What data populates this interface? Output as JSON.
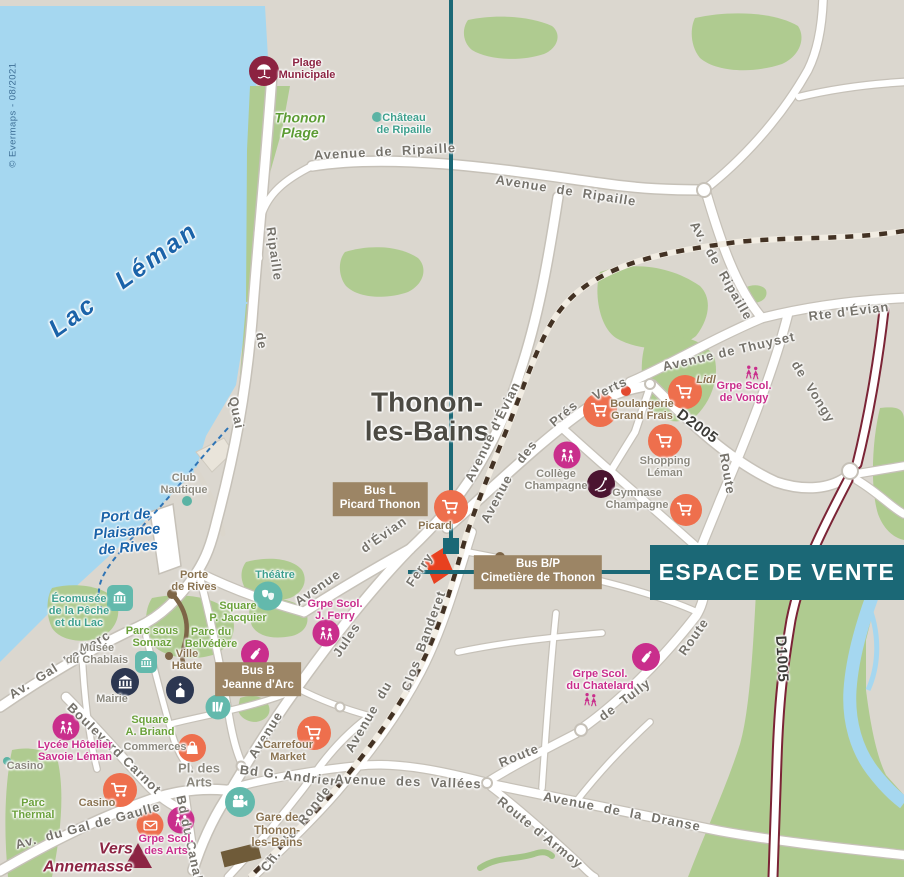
{
  "meta": {
    "banner_label": "ESPACE DE VENTE",
    "copyright": "© Evermaps - 08/2021"
  },
  "colors": {
    "accent": "#1b6876",
    "land": "#dbd7cf",
    "water": "#a5d7f0",
    "green": "#afcb90",
    "orange_poi": "#ee6f4d",
    "pink_poi": "#c92e8c",
    "teal_poi": "#63b9ac",
    "navy_poi": "#2c3751",
    "maroon_poi": "#8c2341",
    "dark_maroon_poi": "#4b1430",
    "brown_badge": "#9c8565",
    "brown_dot": "#7d6547",
    "red_site_marker": "#e8401f",
    "railway": "#433224",
    "d_road_border": "#7b2436"
  },
  "labels": [
    {
      "t": "Thonon-\nles-Bains",
      "x": 427,
      "y": 417,
      "c": "city",
      "n": "city-name"
    },
    {
      "t": "Lac   Léman",
      "x": 124,
      "y": 280,
      "r": -36,
      "c": "water-lg",
      "n": "lake-name"
    },
    {
      "t": "Port de\nPlaisance\nde Rives",
      "x": 127,
      "y": 533,
      "r": -5,
      "c": "water-md",
      "n": "port-name"
    },
    {
      "t": "Avenue  de  Ripaille",
      "x": 385,
      "y": 152,
      "r": -3,
      "c": "street"
    },
    {
      "t": "Avenue  de  Ripaille",
      "x": 566,
      "y": 191,
      "r": 9,
      "c": "street"
    },
    {
      "t": "Av.  de  Ripaille",
      "x": 721,
      "y": 271,
      "r": 60,
      "c": "street"
    },
    {
      "t": "Rte d'Évian",
      "x": 849,
      "y": 312,
      "r": -7,
      "c": "street"
    },
    {
      "t": "Avenue de Thuyset",
      "x": 729,
      "y": 352,
      "r": -13,
      "c": "street"
    },
    {
      "t": "de  Vongy",
      "x": 813,
      "y": 392,
      "r": 58,
      "c": "street"
    },
    {
      "t": "Route",
      "x": 727,
      "y": 474,
      "r": 80,
      "c": "street"
    },
    {
      "t": "Avenue d'Évian",
      "x": 493,
      "y": 432,
      "r": -64,
      "c": "street"
    },
    {
      "t": "Avenue",
      "x": 318,
      "y": 588,
      "r": -35,
      "c": "street"
    },
    {
      "t": "d'Évian",
      "x": 384,
      "y": 535,
      "r": -35,
      "c": "street"
    },
    {
      "t": "Avenue",
      "x": 497,
      "y": 499,
      "r": -62,
      "c": "street"
    },
    {
      "t": "des",
      "x": 527,
      "y": 452,
      "r": -52,
      "c": "street"
    },
    {
      "t": "Prés",
      "x": 564,
      "y": 414,
      "r": -40,
      "c": "street"
    },
    {
      "t": "Verts",
      "x": 610,
      "y": 389,
      "r": -26,
      "c": "street"
    },
    {
      "t": "Jules",
      "x": 347,
      "y": 640,
      "r": -56,
      "c": "street"
    },
    {
      "t": "Ferry",
      "x": 420,
      "y": 570,
      "r": -56,
      "c": "street"
    },
    {
      "t": "Avenue",
      "x": 266,
      "y": 735,
      "r": -58,
      "c": "street"
    },
    {
      "t": "Quai",
      "x": 236,
      "y": 413,
      "r": 78,
      "c": "street"
    },
    {
      "t": "de",
      "x": 261,
      "y": 341,
      "r": 80,
      "c": "street"
    },
    {
      "t": "Ripaille",
      "x": 274,
      "y": 254,
      "r": 82,
      "c": "street"
    },
    {
      "t": "Av.  Gal  Leclerc",
      "x": 60,
      "y": 665,
      "r": -32,
      "c": "street"
    },
    {
      "t": "Boulevard Carnot",
      "x": 114,
      "y": 749,
      "r": 44,
      "c": "street"
    },
    {
      "t": "Av.  du Gal de Gaulle",
      "x": 88,
      "y": 826,
      "r": -15,
      "c": "street"
    },
    {
      "t": "Bd du Canal",
      "x": 189,
      "y": 838,
      "r": 78,
      "c": "street"
    },
    {
      "t": "Bd G. Andrier",
      "x": 288,
      "y": 776,
      "r": 7,
      "c": "street"
    },
    {
      "t": "Avenue  des  Vallées",
      "x": 408,
      "y": 782,
      "r": 2,
      "c": "street"
    },
    {
      "t": "Avenue  de  la  Dranse",
      "x": 622,
      "y": 812,
      "r": 11,
      "c": "street"
    },
    {
      "t": "Route d'Armoy",
      "x": 540,
      "y": 833,
      "r": 39,
      "c": "street"
    },
    {
      "t": "Ch.  de  Ronde",
      "x": 296,
      "y": 829,
      "r": -52,
      "c": "street"
    },
    {
      "t": "Avenue  du",
      "x": 369,
      "y": 717,
      "r": -60,
      "c": "street"
    },
    {
      "t": "Clos  Banderet",
      "x": 424,
      "y": 641,
      "r": -70,
      "c": "street"
    },
    {
      "t": "Route",
      "x": 519,
      "y": 756,
      "r": -22,
      "c": "street"
    },
    {
      "t": "de  Tully",
      "x": 625,
      "y": 700,
      "r": -37,
      "c": "street"
    },
    {
      "t": "Route",
      "x": 694,
      "y": 637,
      "r": -55,
      "c": "street"
    },
    {
      "t": "D2005",
      "x": 697,
      "y": 427,
      "r": 36,
      "c": "droad",
      "n": "road-ref-d2005"
    },
    {
      "t": "D1005",
      "x": 781,
      "y": 659,
      "r": 87,
      "c": "droad",
      "n": "road-ref-d1005"
    },
    {
      "t": "Plage\nMunicipale",
      "x": 307,
      "y": 69,
      "c": "poi-maroon"
    },
    {
      "t": "Thonon\nPlage",
      "x": 300,
      "y": 126,
      "c": "poi-green-lg"
    },
    {
      "t": "Château\nde Ripaille",
      "x": 404,
      "y": 124,
      "c": "poi-teal"
    },
    {
      "t": "Club\nNautique",
      "x": 184,
      "y": 484,
      "c": "poi-gray"
    },
    {
      "t": "Écomusée\nde la Pêche\net du Lac",
      "x": 79,
      "y": 611,
      "c": "poi-teal"
    },
    {
      "t": "Porte\nde Rives",
      "x": 194,
      "y": 581,
      "c": "poi-brown"
    },
    {
      "t": "Théâtre",
      "x": 275,
      "y": 575,
      "c": "poi-teal"
    },
    {
      "t": "Square\nP. Jacquier",
      "x": 238,
      "y": 612,
      "c": "poi-green"
    },
    {
      "t": "Parc sous\nSonnaz",
      "x": 152,
      "y": 637,
      "c": "poi-green"
    },
    {
      "t": "Parc du\nBelvédère",
      "x": 211,
      "y": 638,
      "c": "poi-green"
    },
    {
      "t": "Musée\ndu Chablais",
      "x": 97,
      "y": 654,
      "c": "poi-gray"
    },
    {
      "t": "Ville\nHaute",
      "x": 187,
      "y": 660,
      "c": "poi-brown"
    },
    {
      "t": "Mairie",
      "x": 112,
      "y": 699,
      "c": "poi-gray"
    },
    {
      "t": "Square\nA. Briand",
      "x": 150,
      "y": 726,
      "c": "poi-green"
    },
    {
      "t": "Commerces",
      "x": 155,
      "y": 747,
      "c": "poi-gray"
    },
    {
      "t": "Casino",
      "x": 25,
      "y": 766,
      "c": "poi-gray"
    },
    {
      "t": "Parc\nThermal",
      "x": 33,
      "y": 809,
      "c": "poi-green"
    },
    {
      "t": "Lycée Hôtelier\nSavoie Léman",
      "x": 75,
      "y": 751,
      "c": "poi-pink"
    },
    {
      "t": "Casino",
      "x": 97,
      "y": 803,
      "c": "poi-brown"
    },
    {
      "t": "Grpe Scol.\ndes Arts",
      "x": 166,
      "y": 845,
      "c": "poi-pink"
    },
    {
      "t": "Pl. des\nArts",
      "x": 199,
      "y": 776,
      "c": "poi-gray",
      "s": 13
    },
    {
      "t": "Carrefour\nMarket",
      "x": 288,
      "y": 751,
      "c": "poi-brown"
    },
    {
      "t": "Gare de\nThonon-\nles-Bains",
      "x": 277,
      "y": 831,
      "c": "poi-brown",
      "s": 11.5,
      "n": "station-label"
    },
    {
      "t": "Grpe Scol.\nJ. Ferry",
      "x": 335,
      "y": 610,
      "c": "poi-pink"
    },
    {
      "t": "Picard",
      "x": 435,
      "y": 526,
      "c": "poi-brown"
    },
    {
      "t": "Collège\nChampagne",
      "x": 556,
      "y": 480,
      "c": "poi-gray"
    },
    {
      "t": "Gymnase\nChampagne",
      "x": 637,
      "y": 499,
      "c": "poi-gray"
    },
    {
      "t": "Shopping\nLéman",
      "x": 665,
      "y": 467,
      "c": "poi-gray"
    },
    {
      "t": "Boulangerie\nGrand Frais",
      "x": 642,
      "y": 410,
      "c": "poi-brown"
    },
    {
      "t": "Lidl",
      "x": 706,
      "y": 380,
      "c": "poi-brown-it"
    },
    {
      "t": "Grpe Scol.\nde Vongy",
      "x": 744,
      "y": 392,
      "c": "poi-pink"
    },
    {
      "t": "Grpe Scol.\ndu Chatelard",
      "x": 600,
      "y": 680,
      "c": "poi-pink"
    },
    {
      "t": "Vers\nAnnemasse",
      "x": 88,
      "y": 858,
      "c": "poi-maroon-lg",
      "n": "direction-annemasse"
    }
  ],
  "pois": [
    {
      "n": "beach-umbrella-icon",
      "i": "umbrella",
      "x": 264,
      "y": 71,
      "d": 30,
      "bg": "#8c2341",
      "fg": "#fff"
    },
    {
      "n": "picard-cart-icon",
      "i": "cart",
      "x": 451,
      "y": 507,
      "d": 34,
      "bg": "#ee6f4d",
      "fg": "#fff"
    },
    {
      "n": "grand-frais-cart-icon",
      "i": "cart",
      "x": 600,
      "y": 410,
      "d": 34,
      "bg": "#ee6f4d",
      "fg": "#fff"
    },
    {
      "n": "shopping-leman-cart-icon",
      "i": "cart",
      "x": 665,
      "y": 441,
      "d": 34,
      "bg": "#ee6f4d",
      "fg": "#fff"
    },
    {
      "n": "lidl-cart-icon",
      "i": "cart",
      "x": 685,
      "y": 392,
      "d": 34,
      "bg": "#ee6f4d",
      "fg": "#fff"
    },
    {
      "n": "store-cart-icon",
      "i": "cart",
      "x": 686,
      "y": 510,
      "d": 32,
      "bg": "#ee6f4d",
      "fg": "#fff"
    },
    {
      "n": "carrefour-cart-icon",
      "i": "cart",
      "x": 314,
      "y": 733,
      "d": 34,
      "bg": "#ee6f4d",
      "fg": "#fff"
    },
    {
      "n": "casino-cart-icon",
      "i": "cart",
      "x": 120,
      "y": 790,
      "d": 34,
      "bg": "#ee6f4d",
      "fg": "#fff"
    },
    {
      "n": "shops-bag-icon",
      "i": "bag",
      "x": 192,
      "y": 748,
      "d": 28,
      "bg": "#ee6f4d",
      "fg": "#fff"
    },
    {
      "n": "post-office-icon",
      "i": "envelope",
      "x": 150,
      "y": 825,
      "d": 27,
      "bg": "#ee6f4d",
      "fg": "#fff"
    },
    {
      "n": "school-jferry-icon",
      "i": "school",
      "x": 326,
      "y": 633,
      "d": 27,
      "bg": "#c92e8c",
      "fg": "#fff"
    },
    {
      "n": "college-champagne-icon",
      "i": "school",
      "x": 567,
      "y": 455,
      "d": 27,
      "bg": "#c92e8c",
      "fg": "#fff"
    },
    {
      "n": "lycee-hotelier-icon",
      "i": "school",
      "x": 66,
      "y": 727,
      "d": 27,
      "bg": "#c92e8c",
      "fg": "#fff"
    },
    {
      "n": "school-des-arts-icon",
      "i": "school",
      "x": 181,
      "y": 820,
      "d": 27,
      "bg": "#c92e8c",
      "fg": "#fff"
    },
    {
      "n": "school-vongy-icon",
      "i": "school",
      "x": 752,
      "y": 372,
      "d": 28,
      "bg": "none",
      "fg": "#c92e8c"
    },
    {
      "n": "school-chatelard-icon",
      "i": "school",
      "x": 590,
      "y": 699,
      "d": 27,
      "bg": "none",
      "fg": "#c92e8c"
    },
    {
      "n": "nursery-jeanne-darc-icon",
      "i": "bottle",
      "x": 255,
      "y": 654,
      "d": 28,
      "bg": "#c92e8c",
      "fg": "#fff"
    },
    {
      "n": "nursery-chatelard-icon",
      "i": "bottle",
      "x": 646,
      "y": 657,
      "d": 28,
      "bg": "#c92e8c",
      "fg": "#fff"
    },
    {
      "n": "gymnase-icon",
      "i": "gymnast",
      "x": 601,
      "y": 484,
      "d": 28,
      "bg": "#4b1430",
      "fg": "#fff"
    },
    {
      "n": "mairie-icon",
      "i": "museum",
      "x": 125,
      "y": 682,
      "d": 28,
      "bg": "#2c3751",
      "fg": "#fff"
    },
    {
      "n": "church-icon",
      "i": "church",
      "x": 180,
      "y": 690,
      "d": 28,
      "bg": "#2c3751",
      "fg": "#fff"
    },
    {
      "n": "library-icon",
      "i": "books",
      "x": 218,
      "y": 707,
      "d": 25,
      "bg": "#63b9ac",
      "fg": "#fff"
    },
    {
      "n": "cinema-icon",
      "i": "cinema",
      "x": 240,
      "y": 802,
      "d": 30,
      "bg": "#63b9ac",
      "fg": "#fff"
    },
    {
      "n": "theatre-icon",
      "i": "theater",
      "x": 268,
      "y": 596,
      "d": 29,
      "bg": "#63b9ac",
      "fg": "#fff"
    },
    {
      "n": "ecomusee-icon",
      "i": "museum",
      "x": 120,
      "y": 598,
      "d": 26,
      "bg": "#63b9ac",
      "fg": "#fff",
      "sq": true
    },
    {
      "n": "musee-chablais-icon",
      "i": "museum",
      "x": 146,
      "y": 662,
      "d": 22,
      "bg": "#63b9ac",
      "fg": "#fff",
      "sq": true
    }
  ],
  "dots": [
    {
      "x": 377,
      "y": 117,
      "r": 5,
      "c": "#5bb3a4",
      "n": "chateau-dot"
    },
    {
      "x": 187,
      "y": 501,
      "r": 5,
      "c": "#5bb3a4",
      "n": "club-nautique-dot"
    },
    {
      "x": 7,
      "y": 761,
      "r": 4,
      "c": "#5bb3a4",
      "n": "casino-dot"
    },
    {
      "x": 172,
      "y": 594,
      "r": 5,
      "c": "#7d6547",
      "n": "porte-de-rives-dot"
    },
    {
      "x": 169,
      "y": 656,
      "r": 4,
      "c": "#7d6547",
      "n": "ville-haute-dot"
    },
    {
      "x": 417,
      "y": 495,
      "r": 5,
      "c": "#7d6547",
      "n": "bus-l-dot"
    },
    {
      "x": 500,
      "y": 557,
      "r": 5,
      "c": "#7d6547",
      "n": "bus-bp-dot"
    },
    {
      "x": 295,
      "y": 683,
      "r": 5,
      "c": "#7d6547",
      "n": "bus-b-dot"
    },
    {
      "x": 626,
      "y": 391,
      "r": 5,
      "c": "#e2492f",
      "n": "boulangerie-dot"
    }
  ],
  "badges": [
    {
      "t": "Bus L\nPicard Thonon",
      "x": 380,
      "y": 499,
      "n": "bus-stop-picard-thonon"
    },
    {
      "t": "Bus B\nJeanne d'Arc",
      "x": 258,
      "y": 679,
      "n": "bus-stop-jeanne-darc"
    },
    {
      "t": "Bus B/P\nCimetière de Thonon",
      "x": 538,
      "y": 572,
      "n": "bus-stop-cimetiere"
    }
  ],
  "shapes": [
    {
      "n": "sales-office-site-marker",
      "type": "polygon",
      "points": "424,560 443,548 453,571 434,584",
      "fill": "#e8401f"
    },
    {
      "n": "station-building",
      "type": "rect",
      "x": 222,
      "y": 847,
      "w": 38,
      "h": 16,
      "rot": -14,
      "cx": 241,
      "cy": 855,
      "fill": "#6f5b39"
    },
    {
      "n": "annemasse-arrow",
      "type": "polygon",
      "points": "124,868 152,868 138,843",
      "fill": "#8c2443"
    }
  ]
}
